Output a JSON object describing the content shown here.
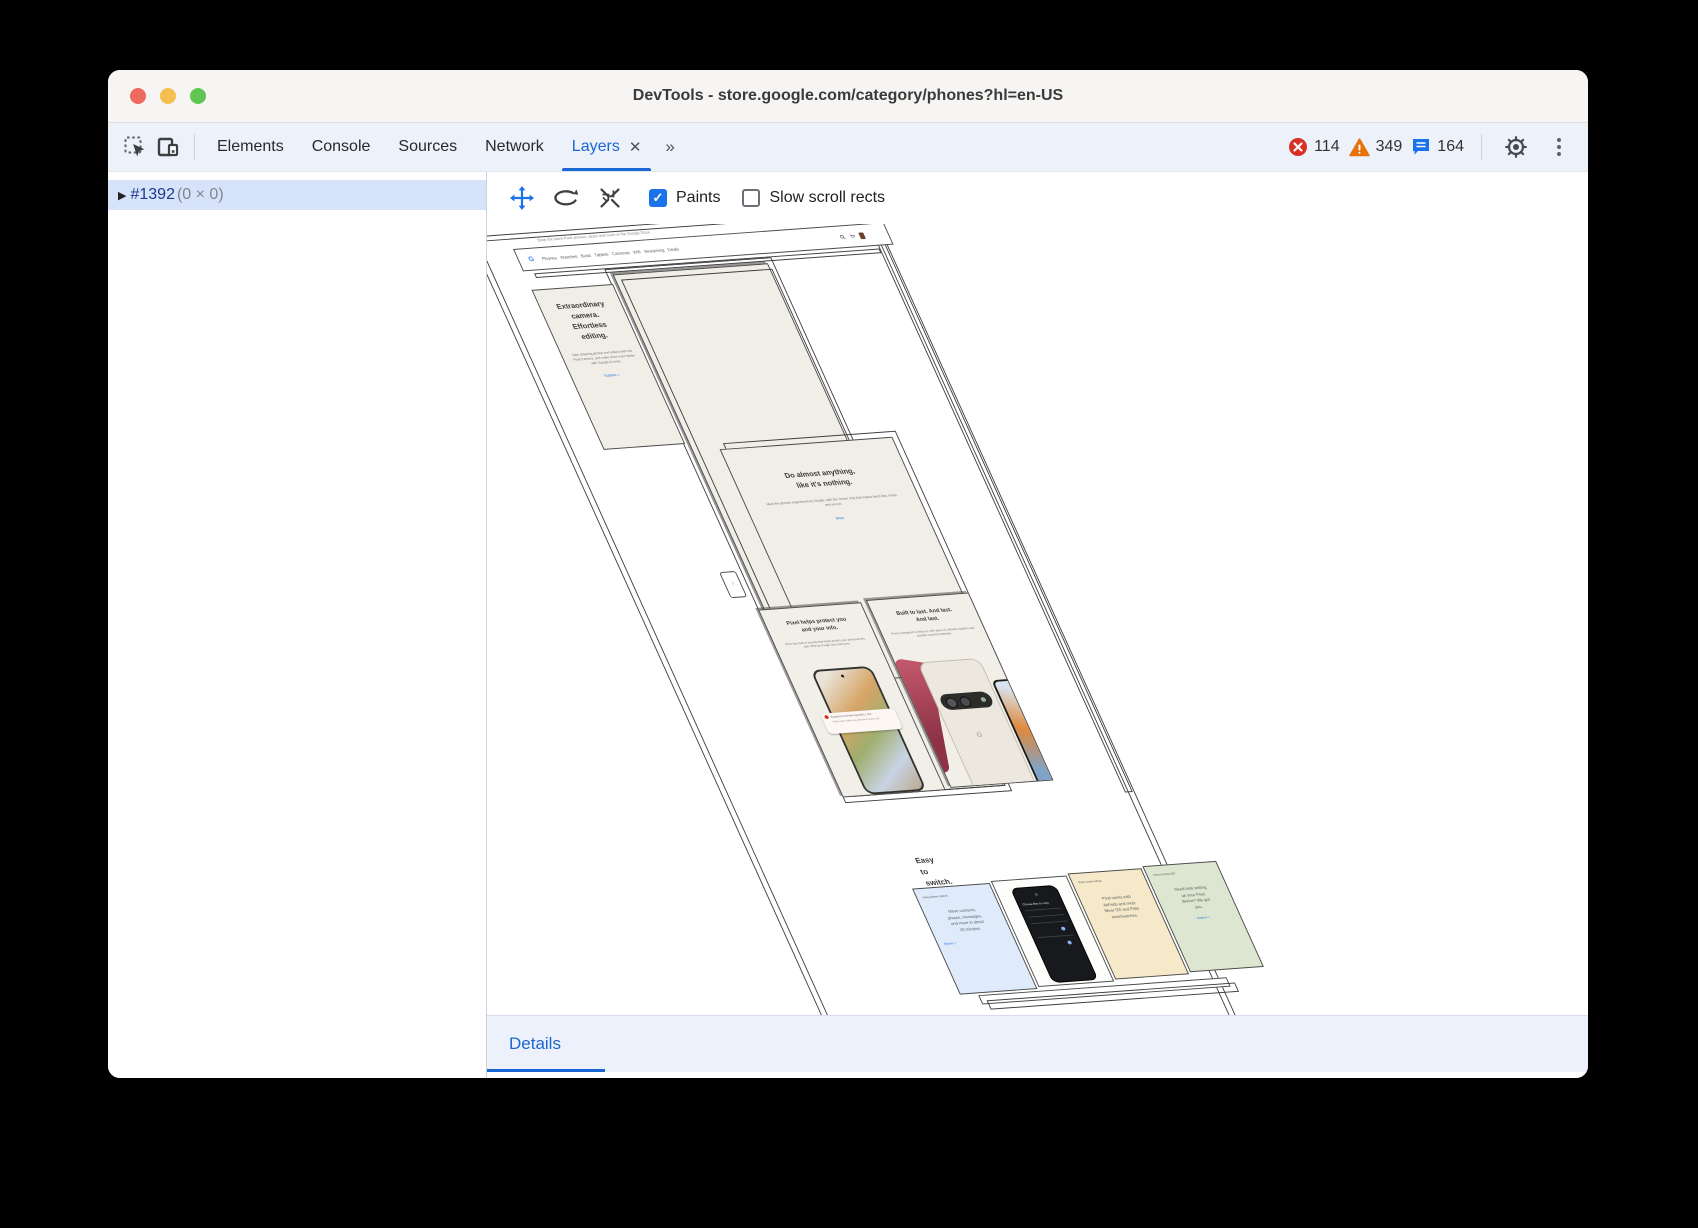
{
  "window": {
    "title": "DevTools - store.google.com/category/phones?hl=en-US"
  },
  "toolbar": {
    "tabs": [
      {
        "label": "Elements"
      },
      {
        "label": "Console"
      },
      {
        "label": "Sources"
      },
      {
        "label": "Network"
      },
      {
        "label": "Layers"
      }
    ],
    "close_glyph": "✕",
    "more_tabs_glyph": "»",
    "badges": {
      "errors": "114",
      "warnings": "349",
      "messages": "164"
    }
  },
  "sidebar": {
    "node": {
      "caret": "▶",
      "id": "#1392",
      "size": "(0 × 0)"
    }
  },
  "layers_toolbar": {
    "paints_label": "Paints",
    "paints_check": "✓",
    "slow_scroll_label": "Slow scroll rects"
  },
  "details": {
    "label": "Details"
  },
  "scene": {
    "top_note": "Shop the latest Pixel phones, deals and more at the Google Store",
    "navbar": {
      "logo": "G",
      "links": "Phones   Watches   Buds   Tablets   Cameras   Wifi   Streaming   Deals"
    },
    "card_camera": {
      "heading": "Extraordinary\ncamera.\nEffortless\nediting.",
      "body": "Take amazing photos and videos with the Pixel Camera, and make them even better with Google AI tools.",
      "link": "Explore >"
    },
    "card_anything": {
      "heading": "Do almost anything,\nlike it's nothing.",
      "body": "Meet the phones engineered by Google, with the Tensor chip that makes them fast, smart and secure.",
      "link": "More"
    },
    "card_protect": {
      "heading": "Pixel helps protect you\nand your info.",
      "body": "Pixel has built-in security that helps protect your personal info, with VPN by Google One and more.",
      "notification_title": "Suspicious Call Warning (555) 1 234",
      "notification_body": "Likely scam caller was detected on this call."
    },
    "card_built": {
      "heading": "Built to last. And last.\nAnd last.",
      "body": "Pixel is designed to keep up, with years of software updates and durable recycled materials.",
      "logo": "G"
    },
    "easy": {
      "heading": "Easy to switch.\nSo much to love.",
      "card_switch": {
        "label": "Easy phone switch",
        "body": "Move contacts,\nphotos, messages,\nand more in about\n20 minutes.",
        "link": "Explore >"
      },
      "card_phone": {
        "screen_title": "Choose files to copy"
      },
      "card_accessories": {
        "label": "Pixel, meet extras",
        "body": "Pixel works with\nAirPods and most\nWear OS and Fitbit\nsmartwatches."
      },
      "card_help": {
        "label": "Here to help 24/7",
        "body": "Need help setting\nup your Pixel\ndevice? We got\nyou.",
        "link": "Explore >"
      }
    }
  }
}
